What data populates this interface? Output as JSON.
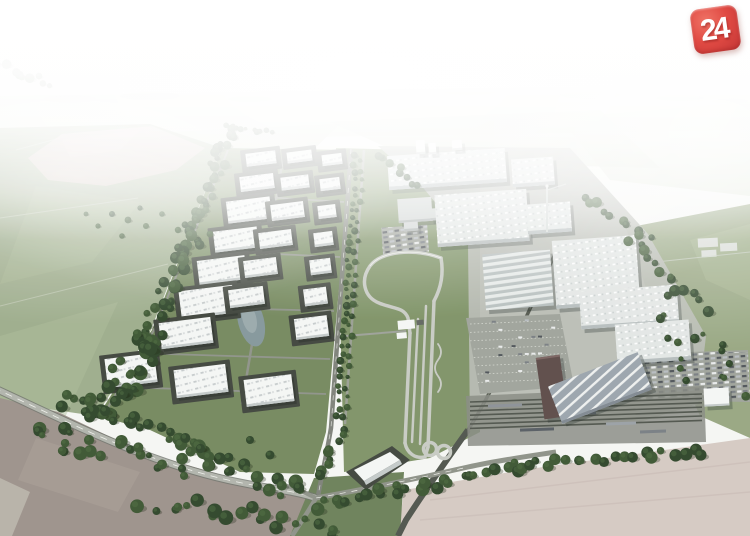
{
  "image": {
    "alt": "Aerial CGI rendering of a large automotive factory complex with a vehicle test track, an industrial park of white warehouse halls, rail yard, parking lots, tree lines and surrounding farm fields fading into haze",
    "watermark": {
      "label": "24"
    }
  },
  "colors": {
    "sky": "#f5f6f3",
    "distantA": "#e3e8da",
    "distantB": "#d7dfcb",
    "distantC": "#ccd6bf",
    "townGray": "#c6ccc3",
    "leftField": "#9dac8b",
    "fieldPatchLight": "#aebc98",
    "plowedPink": "#ccbdb3",
    "plowedLight": "#d7c5bc",
    "rightField": "#97a681",
    "trackField": "#7e9266",
    "parkGround": "#74885d",
    "parkPlot": "#3f443c",
    "parkRoad": "#8e9289",
    "roadMid": "#7d8178",
    "roadLight": "#b0b4ab",
    "roadEdge": "#6e726a",
    "roadWhite": "#f0f1ec",
    "concrete": "#b7bab2",
    "parkingGray": "#9fa39b",
    "rail": "#4f544b",
    "railLight": "#787d72",
    "pond": "#84969b",
    "pondLight": "#a2b0b2",
    "treeDark": "#2d4428",
    "treeMid": "#3b5530",
    "treeLight": "#4e6b3f",
    "buildingWhite": "#f4f6f4",
    "buildingSide": "#c3c9c8",
    "factoryRoof": "#e2e6e4",
    "factorySide": "#b6bdbd",
    "grayBld": "#cdd2d0",
    "graySide": "#aab0ae",
    "ridgeLight": "#e7ebe9",
    "ridgeDark": "#b8c0bf",
    "whStripeBase": "#9ba4ac",
    "whStripeLight": "#eef0ef",
    "whSide": "#7f8890",
    "maroon": "#5c4a47",
    "maroonTop": "#7a6360",
    "brownField": "#9c918a",
    "brownField2": "#a89d94",
    "cornerStrip": "#b7b1a7",
    "paleField": "#d5c9c2",
    "paleField2": "#c8bab4",
    "bottomGreen": "#6b7f58",
    "trackGray": "#c7cac3",
    "carWhite": "#e9ebeb",
    "carDark": "#787d82",
    "carMid": "#b7bcc0",
    "carDeep": "#4e5358",
    "logoRed": "#e04a43",
    "logoRedLight": "#ef7265",
    "logoRedDark": "#c23535",
    "logoText": "#ffffff"
  }
}
